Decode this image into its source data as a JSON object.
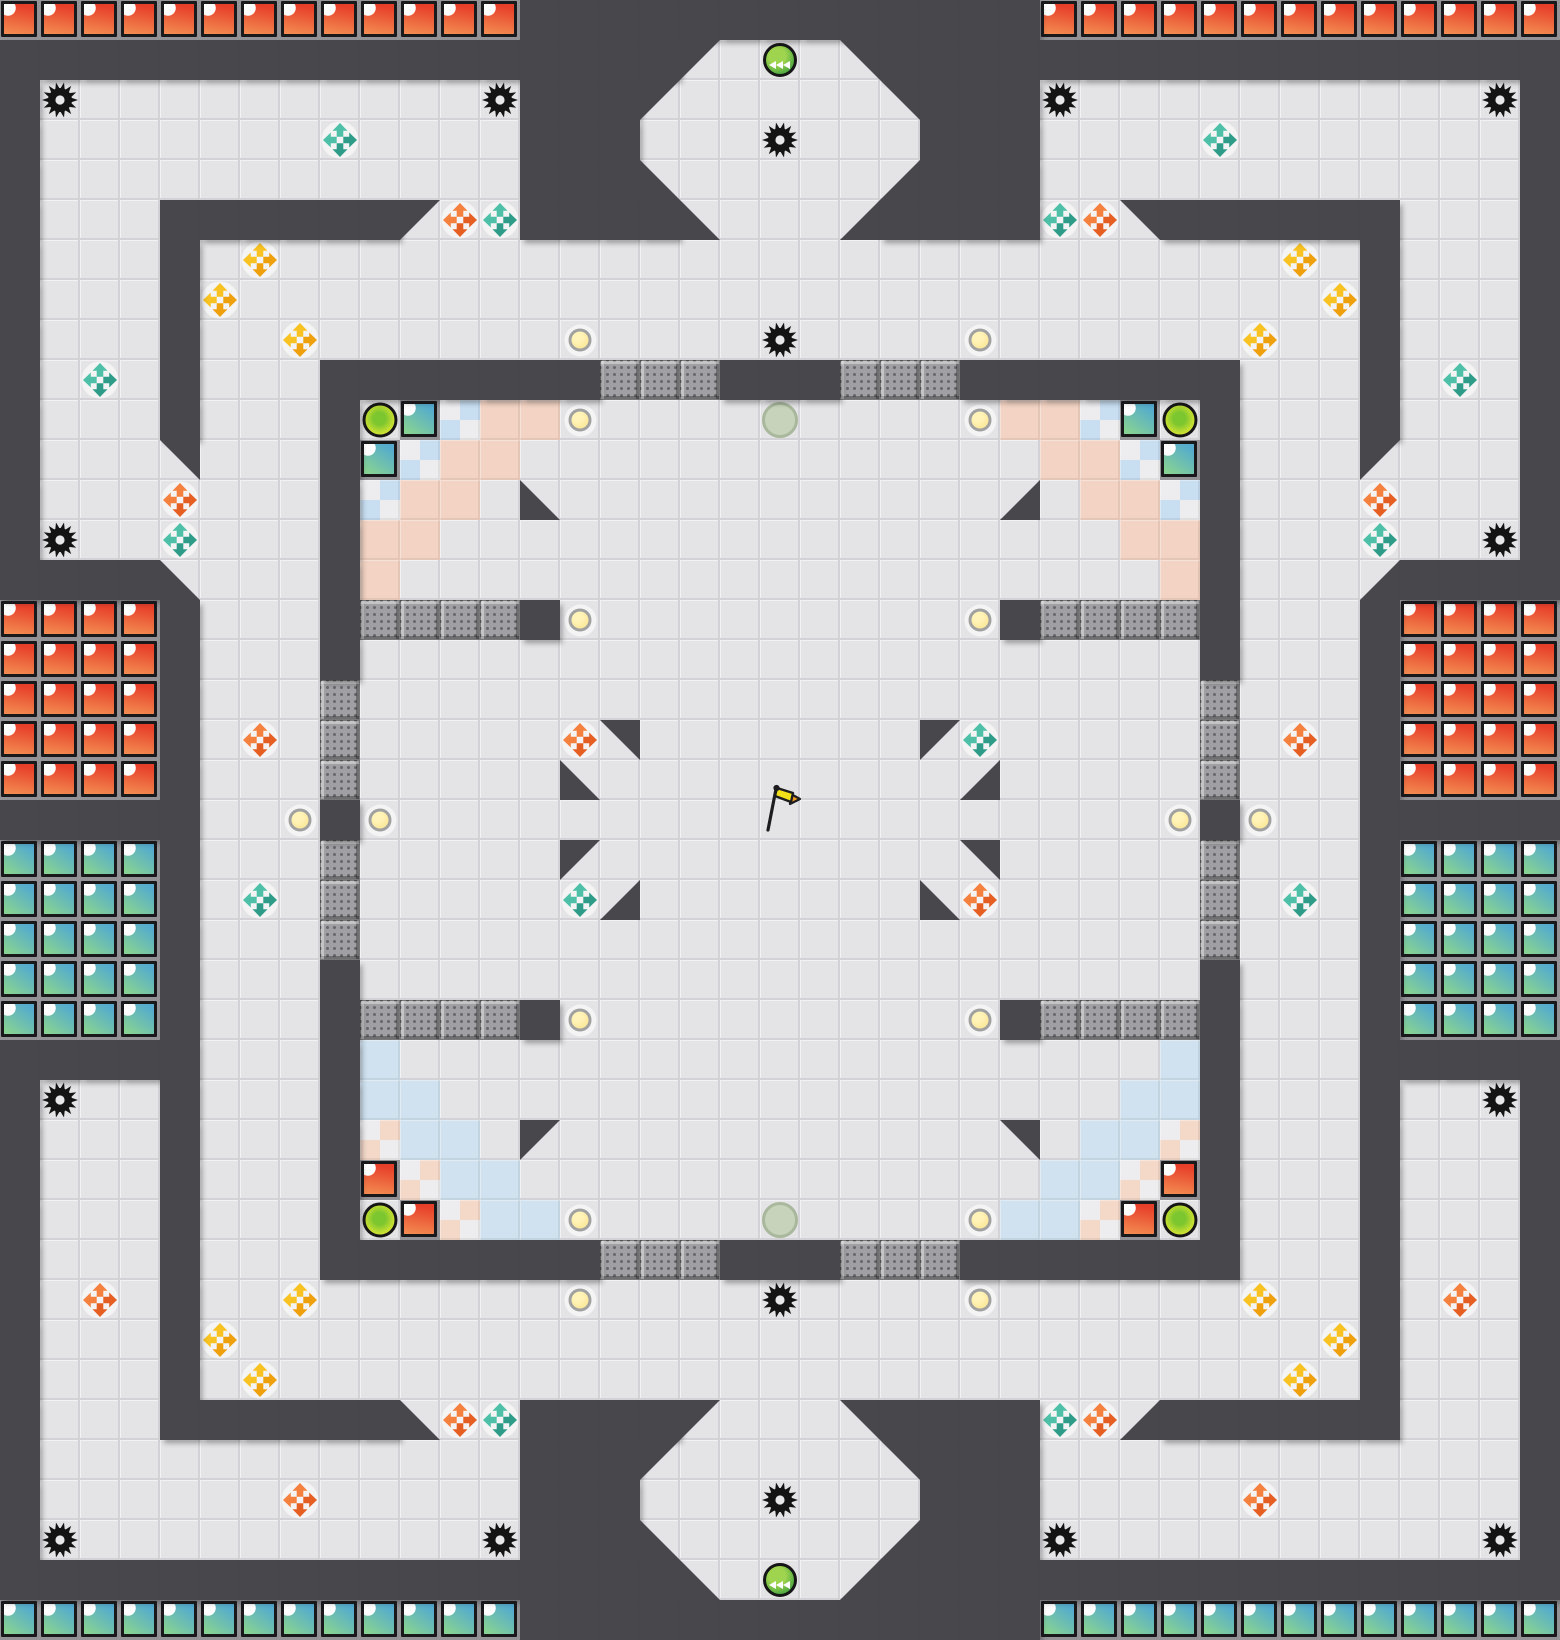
{
  "meta": {
    "title": "Capture-the-flag arena tile map",
    "cols": 39,
    "rows": 41,
    "tile_px": 40
  },
  "legend": {
    "#": "wall",
    ".": "floor",
    "R": "red-team-tile",
    "T": "teal-team-tile",
    "P": "pink-zone-tile",
    "B": "blue-zone-tile",
    "h": "blue-checker-tile",
    "k": "pink-checker-tile",
    "G": "grate-tile",
    "1": "wall-wedge-top-left",
    "2": "wall-wedge-top-right",
    "3": "wall-wedge-bottom-left",
    "4": "wall-wedge-bottom-right",
    "g": "gear-hazard",
    "o": "yellow-dot",
    "y": "corner-button",
    "m": "muted-button",
    "O": "green-portal",
    "c": "boost-pad-teal",
    "n": "boost-pad-orange",
    "w": "boost-pad-yellow",
    "F": "flag"
  },
  "tiles": [
    "RRRRRRRRRRRRR#############RRRRRRRRRRRRR",
    "#################1.O.2#################",
    "#g..........g###1.....2###g..........g#",
    "#.......c....###...g...###....c.......#",
    "#............###3.....4###............#",
    "#...######1nc####3...4####cn2######...#",
    "#...#.w.........................w.#...#",
    "#...#w...........................w#...#",
    "#...#..w......o....g....o......w..#...#",
    "#.c.#...#######GGG###GGG#######...#.c.#",
    "#...#...#yThPPo....m....oPPhTy#...#...#",
    "#...2...#ThPP.............PPhT#...1...#",
    "#...n...#hPP.3...........4.PPh#...n...#",
    "#g..c...#PP.................PP#...c..g#",
    "####3...#P...................P#...4####",
    "RRRR#...#GGGG#o.........o#GGGG#...#RRRR",
    "RRRR#...#.....................#...#RRRR",
    "RRRR#...G.....................G...#RRRR",
    "RRRR#.n.G.....n2.......1c.....G.n.#RRRR",
    "RRRR#...G.....3.........4.....G...#RRRR",
    "#####..o#o.........F.........o#o..#####",
    "TTTT#...G.....1.........2.....G...#TTTT",
    "TTTT#.c.G.....c4.......3n.....G.c.#TTTT",
    "TTTT#...G.....................G...#TTTT",
    "TTTT#...#.....................#...#TTTT",
    "TTTT#...#GGGG#o.........o#GGGG#...#TTTT",
    "#####...#B...................B#...#####",
    "#g..#...#BB.................BB#...#..g#",
    "#...#...#kBB.1...........2.BBk#...#...#",
    "#...#...#RkBB.............BBkR#...#...#",
    "#...#...#yRkBBo....m....oBBkRy#...#...#",
    "#...#...#######GGG###GGG#######...#...#",
    "#.n.#..w......o....g....o......w..#.n.#",
    "#...#w...........................w#...#",
    "#...#.w.........................w.#...#",
    "#...######3nc####1...2####cn4######...#",
    "#............###1.....2###............#",
    "#......n.....###...g...###.....n......#",
    "#g..........g###3.....4###g..........g#",
    "#################3.O.4#################",
    "TTTTTTTTTTTTT#############TTTTTTTTTTTTT"
  ],
  "colors": {
    "wall": "#47474c",
    "floor": "#e4e4e7",
    "floor_line": "#d3d3d7",
    "floor_hi": "#f2f2f4",
    "pink": "#f3d3c3",
    "blue": "#d0e2f0",
    "checker_blue": "#c8dff2",
    "checker_pink": "#f4d9c9",
    "checker_white": "#ededef",
    "grate_bg": "#a0a0a4",
    "grate_dot": "#68686d",
    "grate_hi": "rgba(255,255,255,.38)",
    "grate_sh": "rgba(0,0,0,.30)",
    "team_gap": "#929297",
    "team_border": "#19191c",
    "red_a": "#e7402a",
    "red_b": "#f28a50",
    "teal_a": "#54abce",
    "teal_b": "#86d194",
    "fold": "#ffffff",
    "gear": "#141414",
    "gear_hole": "#e8e8ea",
    "ring": "#161616",
    "dot_a": "#ffe14d",
    "dot_b": "#f6c306",
    "plate": "rgba(255,255,255,.60)",
    "btn_a": "#7cc62f",
    "btn_b": "#e9e93a",
    "portal_a": "#9ed44e",
    "portal_b": "#3c9f3e",
    "chevron": "#ffffff",
    "muted_bg": "#c7d3ba",
    "muted_ring": "#a9b89c",
    "boost_teal_light": "#4fc0a8",
    "boost_teal_dark": "#2f9c89",
    "boost_orange_light": "#f5813f",
    "boost_orange_dark": "#e55f22",
    "boost_yellow_light": "#f8c222",
    "boost_yellow_dark": "#eea10d",
    "flag_pole": "#1d1d1f",
    "flag_yellow": "#f2e118",
    "flag_orange": "#f59d1d"
  }
}
